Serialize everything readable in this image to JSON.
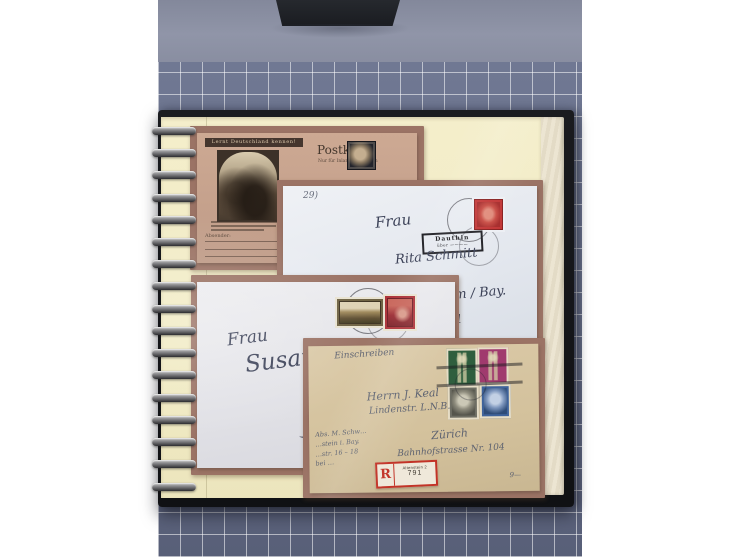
{
  "scene": {
    "description": "Open spiral-bound stamp album page with four German postal covers, photographed on a grid cutting mat",
    "colors": {
      "background_white": "#ffffff",
      "mat_grid_surface": "#68708a",
      "mat_grid_lines": "#ffffff",
      "table_surface": "#9095a8",
      "album_cover": "#141519",
      "album_page": "#f3edc8",
      "mount_border": "#9b7365",
      "registration_red": "#c23327"
    }
  },
  "postcard": {
    "slogan": "Lernt Deutschland kennen!",
    "title": "Postkarte",
    "subtitle": "Nur für Inland zugelassen",
    "sender_label": "Absender:"
  },
  "white_cover": {
    "corner_note": "29)",
    "salutation": "Frau",
    "name": "Rita Schmitt",
    "town": "…heim / Bay.",
    "house": "Nr. 11",
    "cancel_line1": "Dauthin",
    "cancel_line2": "über ————",
    "stamp_color": "#c13434"
  },
  "grey_cover": {
    "salutation": "Frau",
    "name": "Susanne",
    "stamp_colors": {
      "left": "#6e6243",
      "right": "#ac3138"
    }
  },
  "tan_cover": {
    "endorsement": "Einschreiben",
    "addressee_line1": "Herrn J. Keal",
    "addressee_line2": "Lindenstr. L.N.B.",
    "city": "Zürich",
    "street": "Bahnhofstrasse Nr. 104",
    "sender_line1": "Abs. M. Schw…",
    "sender_line2": "…stein i. Bay.",
    "sender_line3": "…str. 16 – 18",
    "sender_line4": "bei …",
    "pencil_note": "9—",
    "registration": {
      "letter": "R",
      "office": "Altenstein 2",
      "number": "791"
    },
    "stamp_colors": {
      "green": "#2f5e3e",
      "magenta": "#a03a6e",
      "grey": "#6e6e64",
      "blue": "#3f639b"
    }
  }
}
